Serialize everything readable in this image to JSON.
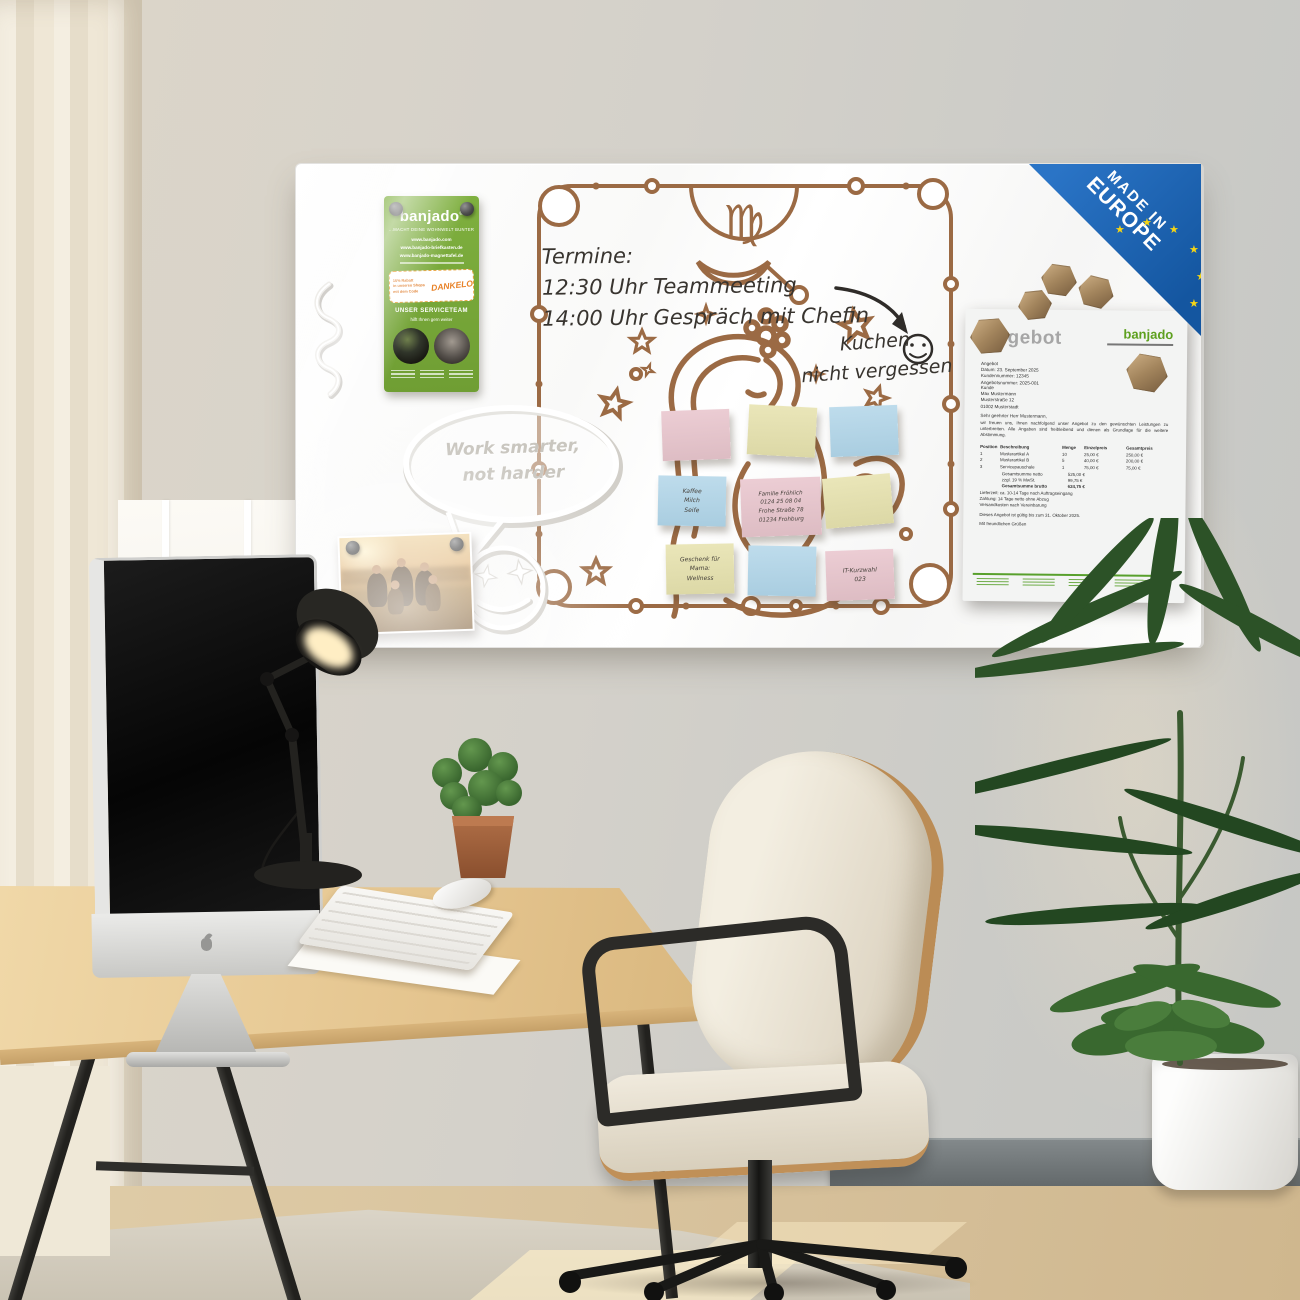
{
  "badge": {
    "line1": "MADE IN",
    "line2": "EUROPE"
  },
  "flyer": {
    "brand": "banjado",
    "reg": "®",
    "tagline": "...MACHT DEINE WOHNWELT BUNTER",
    "urls": [
      "www.banjado.com",
      "www.banjado-briefkasten.de",
      "www.banjado-magnettafel.de"
    ],
    "promo_lines": "15% Rabatt\nin unseren Shops\nmit dem Code",
    "promo_code": "DANKELO",
    "service_title": "UNSER SERVICETEAM",
    "service_sub": "hilft Ihnen gern weiter"
  },
  "board": {
    "zodiac_symbol": "♍",
    "handwriting": {
      "termine": "Termine:\n12:30 Uhr Teammeeting\n14:00 Uhr Gespräch mit Chefin",
      "kuchen": "Kuchen\nnicht vergessen"
    },
    "bubble": "Work smarter,\nnot harder"
  },
  "notes": {
    "kaffee": "Kaffee\nMilch\nSeife",
    "familie": "Familie Fröhlich\n0124 25 08 04\nFrohe Straße 78\n01234 Frohburg",
    "geschenk": "Geschenk für\nMama:\nWellness",
    "kurzwahl": "IT-Kurzwahl\n023"
  },
  "invoice": {
    "title": "Angebot",
    "logo": "banjado",
    "meta": "Angebot\nDatum: 23. September 2025\nKundennummer: 12345\nAngebotsnummer: 2025-001",
    "customer": "Kunde\nMax Mustermann\nMusterstraße 12\n01002 Musterstadt",
    "salutation": "Sehr geehrter Herr Mustermann,",
    "body": "wir freuen uns, Ihnen nachfolgend unser Angebot zu den gewünschten Leistungen zu unterbreiten. Alle Angaben sind freibleibend und dienen als Grundlage für die weitere Abstimmung.",
    "table": {
      "headers": [
        "Position",
        "Beschreibung",
        "Menge",
        "Einzelpreis",
        "Gesamtpreis"
      ],
      "rows": [
        [
          "1",
          "Musterartikel A",
          "10",
          "25,00 €",
          "250,00 €"
        ],
        [
          "2",
          "Musterartikel B",
          "5",
          "40,00 €",
          "200,00 €"
        ],
        [
          "3",
          "Servicepauschale",
          "1",
          "75,00 €",
          "75,00 €"
        ]
      ],
      "totals": [
        [
          "Gesamtsumme netto",
          "525,00 €"
        ],
        [
          "zzgl. 19 % MwSt.",
          "99,75 €"
        ],
        [
          "Gesamtsumme brutto",
          "624,75 €"
        ]
      ]
    },
    "terms": "Lieferzeit: ca. 10-14 Tage nach Auftragseingang\nZahlung: 14 Tage netto ohne Abzug\nVersandkosten nach Vereinbarung",
    "validity": "Dieses Angebot ist gültig bis zum 31. Oktober 2025.",
    "closing": "Mit freundlichen Grüßen"
  },
  "colors": {
    "banjado_green": "#76a832",
    "badge_blue": "#1a5fae",
    "star_yellow": "#f5d216",
    "line_brown": "#9b6a44",
    "note_pink": "#e5c6cd",
    "note_yellow": "#e6e2b4",
    "note_blue": "#b8d8e8"
  }
}
